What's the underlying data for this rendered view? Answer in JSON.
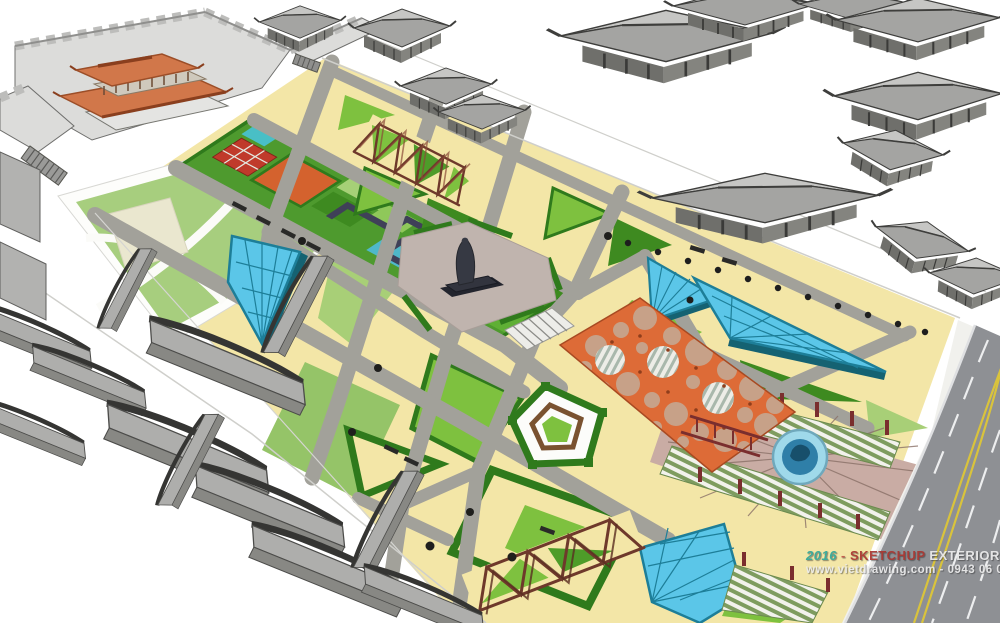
{
  "watermark": {
    "year": "2016",
    "separator": "-",
    "brand": "SKETCHUP",
    "suffix": "EXTERIOR VOL.16",
    "contact": "www.vietdrawing.com - 0943 06 06 08"
  },
  "colors": {
    "paving": "#F3E6A7",
    "path": "#A2A19A",
    "lawn-bright": "#7EC13F",
    "lawn-mid": "#4E9C29",
    "lawn-dark": "#3E8A20",
    "lawn-pale": "#A8CF77",
    "lawn-soft": "#95C468",
    "hedge": "#2F7A1C",
    "glass": "#5BC6E8",
    "glass-frame": "#1D7E98",
    "glass-edge": "#156272",
    "canopy": "#DD6B37",
    "canopy-edge": "#A84A22",
    "canopy-ground": "#C7A188",
    "roof-orange": "#D1774A",
    "roof-orange-dark": "#9C4E28",
    "accent-orange": "#D4622E",
    "garden-green": "#4E9A2E",
    "teal": "#49BFC6",
    "navy": "#3F4058",
    "building-light": "#C6C6C4",
    "building-mid": "#A4A4A2",
    "building-dark": "#6F6F6B",
    "wall-light": "#DCDCDA",
    "outline": "#3E3E3C",
    "road": "#8E9094",
    "road-yellow": "#D9C33C",
    "water": "#2F7FA8",
    "water-ring": "#9FD9EA",
    "fan-pink": "#C9ACA4",
    "stripe-olive": "#7E9C5F",
    "stripe-bg": "#F2F2EC",
    "post-red": "#7A2E2E",
    "truss": "#6E392B",
    "plaza-mauve": "#C0B4AE",
    "statue": "#363943",
    "wm-year": "#2FA79A",
    "wm-sep": "#C05548",
    "wm-brand": "#A93530",
    "wm-text": "#ECECEC"
  }
}
